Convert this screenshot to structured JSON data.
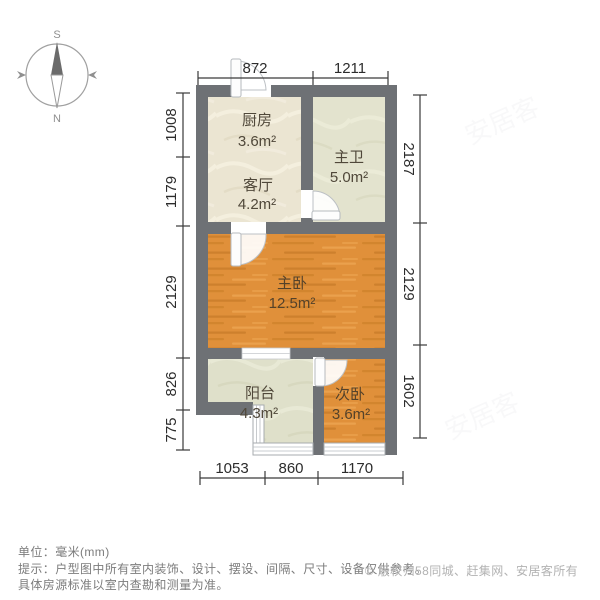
{
  "compass": {
    "south": "S",
    "north": "N"
  },
  "rooms": [
    {
      "id": "kitchen",
      "name": "厨房",
      "area": "3.6m²"
    },
    {
      "id": "master-bath",
      "name": "主卫",
      "area": "5.0m²"
    },
    {
      "id": "living-room",
      "name": "客厅",
      "area": "4.2m²"
    },
    {
      "id": "master-bedroom",
      "name": "主卧",
      "area": "12.5m²"
    },
    {
      "id": "balcony",
      "name": "阳台",
      "area": "4.3m²"
    },
    {
      "id": "second-bedroom",
      "name": "次卧",
      "area": "3.6m²"
    }
  ],
  "dimensions": {
    "top": [
      "872",
      "1211"
    ],
    "left": [
      "1008",
      "1179",
      "2129",
      "826",
      "775"
    ],
    "right": [
      "2187",
      "2129",
      "1602"
    ],
    "bottom": [
      "1053",
      "860",
      "1170"
    ]
  },
  "watermark": {
    "text": "安居客"
  },
  "footer": {
    "unit_line": "单位：毫米(mm)",
    "tip_line1": "提示：户型图中所有室内装饰、设计、摆设、间隔、尺寸、设备仅供参考。",
    "tip_line2": "具体房源标准以室内查勘和测量为准。",
    "copyright": "© 版权归58同城、赶集网、安居客所有"
  },
  "colors": {
    "wall": "#6e7175",
    "wood_floor": "#e0903a",
    "stone_floor": "#ebe5d2",
    "bath_floor": "#e3e3ce",
    "balcony_floor": "#dfe0ca",
    "dimension_text": "#2c2c2c",
    "footer_text": "#7c7c7c",
    "copyright_text": "#b2b2b2"
  }
}
